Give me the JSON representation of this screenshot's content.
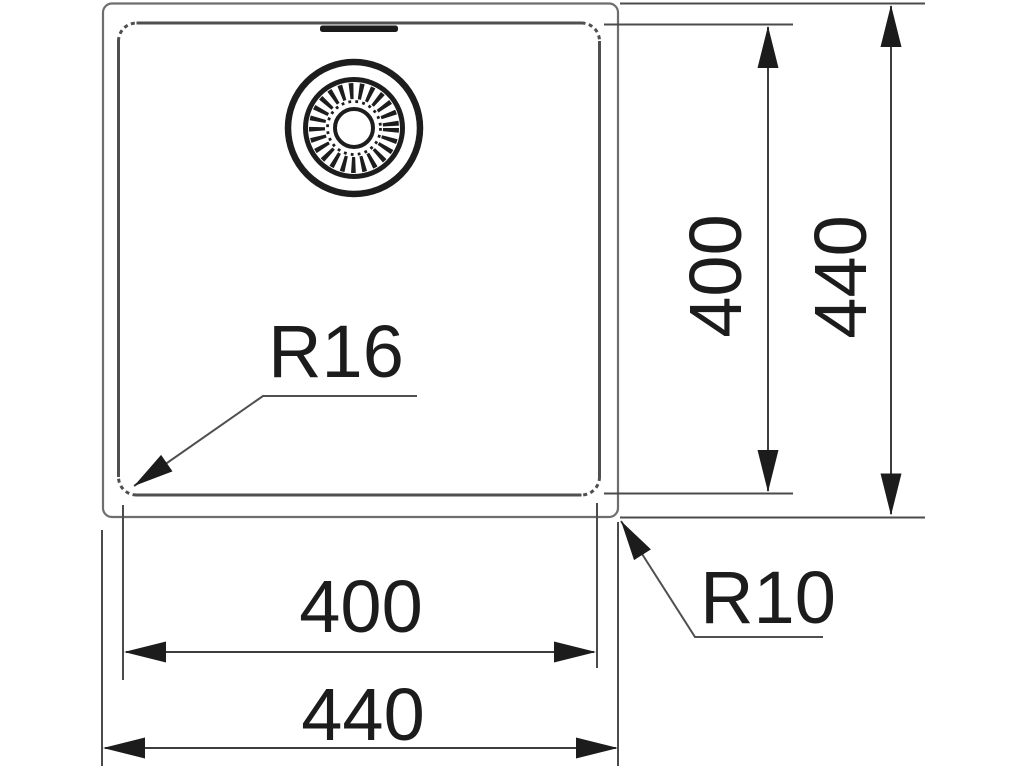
{
  "drawing": {
    "title": "sink-top-view-technical-drawing",
    "radius_callouts": [
      {
        "id": "bowl-corner-radius",
        "label": "R16"
      },
      {
        "id": "outer-corner-radius",
        "label": "R10"
      }
    ],
    "dimensions": [
      {
        "id": "bowl-width",
        "value": "400",
        "orientation": "horizontal"
      },
      {
        "id": "outer-width",
        "value": "440",
        "orientation": "horizontal"
      },
      {
        "id": "bowl-height",
        "value": "400",
        "orientation": "vertical"
      },
      {
        "id": "outer-height",
        "value": "440",
        "orientation": "vertical"
      }
    ],
    "colors": {
      "background": "#ffffff",
      "outer_outline": "#6e6e6e",
      "bowl_outline": "#4f4f4f",
      "dimension_lines": "#3d3d3d",
      "ink": "#1c1c1c"
    }
  }
}
